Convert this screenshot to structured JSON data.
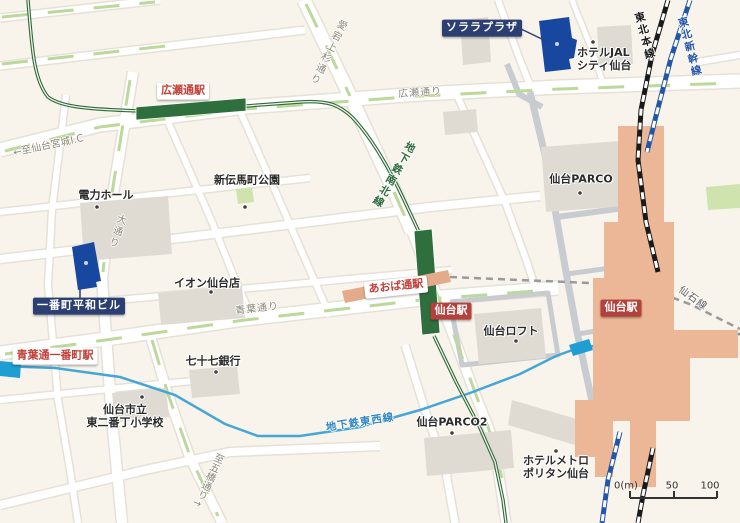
{
  "map_title": "仙台駅周辺アクセスマップ",
  "labels": {
    "solara_plaza": "ソララプラザ",
    "hotel_jal_line1": "ホテルJAL",
    "hotel_jal_line2": "シティ仙台",
    "tohoku_honsen": "東北本線",
    "tohoku_shinkansen": "東北新幹線",
    "hirosedori_station": "広瀬通駅",
    "hirosedori_street": "広瀬通り",
    "to_sendai_miyagi_ic": "←至仙台宮城I.C",
    "denryoku_hall": "電力ホール",
    "shintenmacho_park": "新伝馬町公園",
    "subway_namboku_line": "地下鉄南北線",
    "atago_kamisugi_dori": "愛宕上杉通り",
    "odori": "大通り",
    "sendai_parco": "仙台PARCO",
    "aeon_sendai": "イオン仙台店",
    "ichibancho_heiwa_building": "一番町平和ビル",
    "aobadori_station": "あおば通駅",
    "sendai_station_subway": "仙台駅",
    "sendai_station_jr": "仙台駅",
    "sendai_loft": "仙台ロフト",
    "senseki_line": "仙石線",
    "aobadori_street": "青葉通り",
    "aobadori_ichibancho_station": "青葉通一番町駅",
    "subway_tozai_line": "地下鉄東西線",
    "shichijushichi_bank": "七十七銀行",
    "school_line1": "仙台市立",
    "school_line2": "東二番丁小学校",
    "sendai_parco2": "仙台PARCO2",
    "hotel_metropolitan_line1": "ホテルメトロ",
    "hotel_metropolitan_line2": "ポリタン仙台",
    "to_itsutsubashi_dori": "至五橋通り→"
  },
  "scale_bar": {
    "zero": "0(m)",
    "fifty": "50",
    "hundred": "100"
  },
  "colors": {
    "background": "#f8f4ec",
    "street_white": "#ffffff",
    "street_casing": "#e6e1d7",
    "deck_road_gray": "#c8ccd1",
    "median_green": "#bcd89b",
    "park_green": "#cfe3ae",
    "building_gray": "#dfdbd3",
    "station_building_orange": "#ecb796",
    "aobadori_bar_salmon": "#e3ab8a",
    "namboku_green": "#2c6b3a",
    "station_bar_green": "#2f6f3d",
    "tozai_blue": "#45a6d6",
    "tozai_marker_blue": "#1e9ed2",
    "senseki_gray": "#9a9a9a",
    "jr_line_black": "#1a1a1a",
    "shinkansen_blue": "#2456a8",
    "navy_label_bg": "#2c3f72",
    "blue_building": "#17479e",
    "red_label_bg": "#b5413c",
    "station_text_red": "#c13f36",
    "street_text_gray": "#8c8679",
    "dot_dark": "#3f3f3f"
  }
}
